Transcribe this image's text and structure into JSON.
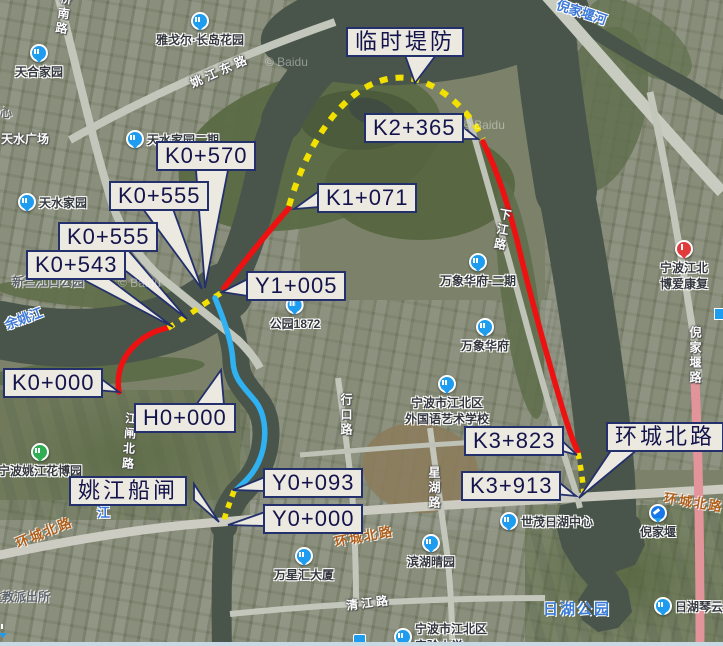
{
  "callouts": {
    "linshi_difang": "临时堤防",
    "k2_365": "K2+365",
    "k1_071": "K1+071",
    "k0_570": "K0+570",
    "k0_555_a": "K0+555",
    "k0_555_b": "K0+555",
    "k0_543": "K0+543",
    "y1_005": "Y1+005",
    "k0_000": "K0+000",
    "h0_000": "H0+000",
    "yaojiang_chuanzha": "姚江船闸",
    "y0_093": "Y0+093",
    "y0_000": "Y0+000",
    "k3_823": "K3+823",
    "k3_913": "K3+913",
    "huancheng_beilu": "环城北路"
  },
  "pois": {
    "tianhe_jiayuan": "天合家园",
    "yageer_changdao": "雅戈尔·长岛花园",
    "tianshui_guangchang": "天水广场",
    "tianshui_jiayuan": "天水家园",
    "tianshui_jiayuan_erqi": "天水家园二期",
    "xinsanjiangkou_gongyuan": "新三江口公园",
    "gongyuan_1872": "公园1872",
    "wanxiang_huafu_erqi": "万象华府-二期",
    "wanxiang_huafu": "万象华府",
    "school_line1": "宁波市江北区",
    "school_line2": "外国语艺术学校",
    "shimao_rihu": "世茂日湖中心",
    "nijiayan_station": "倪家堰",
    "rihu_gongyuan": "日湖公园",
    "rihu_qinyun": "日湖琴云",
    "binhu_qingyuan": "滨湖晴园",
    "wanxinghui_dasha": "万星汇大厦",
    "shiyan_line1": "宁波市江北区",
    "shiyan_line2": "实验小学",
    "huabo_yuan": "宁波姚江花博园",
    "wenjiao_paichusuo": "文教派出所",
    "hospital_line1": "宁波江北",
    "hospital_line2": "博爱康复",
    "xin_fragment": "心"
  },
  "waters": {
    "yuyaojiang": "余姚江",
    "nijiayan_he": "倪家堰河",
    "jiang_fragment": "江"
  },
  "road_labels": {
    "qiaonan_lu": "桥南路",
    "yaojiang_dong_lu": "姚江东路",
    "jiangzha_bei_lu": "江闸北路",
    "xingkou_lu": "行口路",
    "xinghu_lu": "星湖路",
    "qingjiang_lu": "清江路",
    "huancheng_left": "环城北路",
    "huancheng_center": "环城北路",
    "huancheng_right": "环城北路",
    "nijiayan_lu": "倪家堰路",
    "xiajiang_lu": "下江路"
  },
  "watermark": "© Baidu",
  "colors": {
    "route_red": "#ee1111",
    "route_yellow": "#f2e000",
    "route_blue": "#2fb1f2",
    "callout_bg": "#ece9e0",
    "callout_border": "#23306b",
    "water": "#49554a"
  }
}
